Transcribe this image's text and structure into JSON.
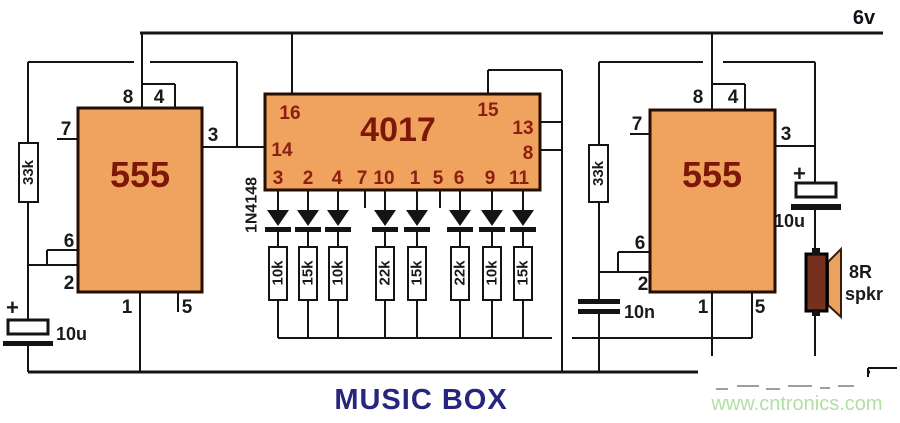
{
  "labels": {
    "supply": "6v",
    "title": "MUSIC BOX",
    "watermark_url": "www.cntronics.com"
  },
  "ic_left_555": {
    "name": "555",
    "pins": {
      "p8": "8",
      "p4": "4",
      "p7": "7",
      "p3": "3",
      "p6": "6",
      "p2": "2",
      "p1": "1",
      "p5": "5"
    }
  },
  "ic_4017": {
    "name": "4017",
    "pins": {
      "p16": "16",
      "p15": "15",
      "p14": "14",
      "p13": "13",
      "p8": "8",
      "bottom": [
        "3",
        "2",
        "4",
        "7",
        "10",
        "1",
        "5",
        "6",
        "9",
        "11"
      ]
    }
  },
  "ic_right_555": {
    "name": "555",
    "pins": {
      "p8": "8",
      "p4": "4",
      "p7": "7",
      "p3": "3",
      "p6": "6",
      "p2": "2",
      "p1": "1",
      "p5": "5"
    }
  },
  "network": {
    "diode_label": "1N4148",
    "resistors": [
      "10k",
      "15k",
      "10k",
      "22k",
      "15k",
      "22k",
      "10k",
      "15k"
    ]
  },
  "components": {
    "r_timing_left": "33k",
    "r_timing_right": "33k",
    "cap_left_plus": "+",
    "cap_left_value": "10u",
    "cap_right_plus": "+",
    "cap_right_value": "10u",
    "cap_10n_value": "10n",
    "speaker_impedance": "8R",
    "speaker_label": "spkr"
  },
  "colors": {
    "ic_fill": "#F0A35E",
    "ic_border": "#230E00",
    "ic_text": "#7D1708",
    "pin_text_red": "#8B2012",
    "wire": "#141414",
    "title_navy": "#26267E",
    "watermark_green": "#B2DFA4",
    "speaker_body": "#75301E",
    "speaker_cone": "#E9A35F"
  }
}
